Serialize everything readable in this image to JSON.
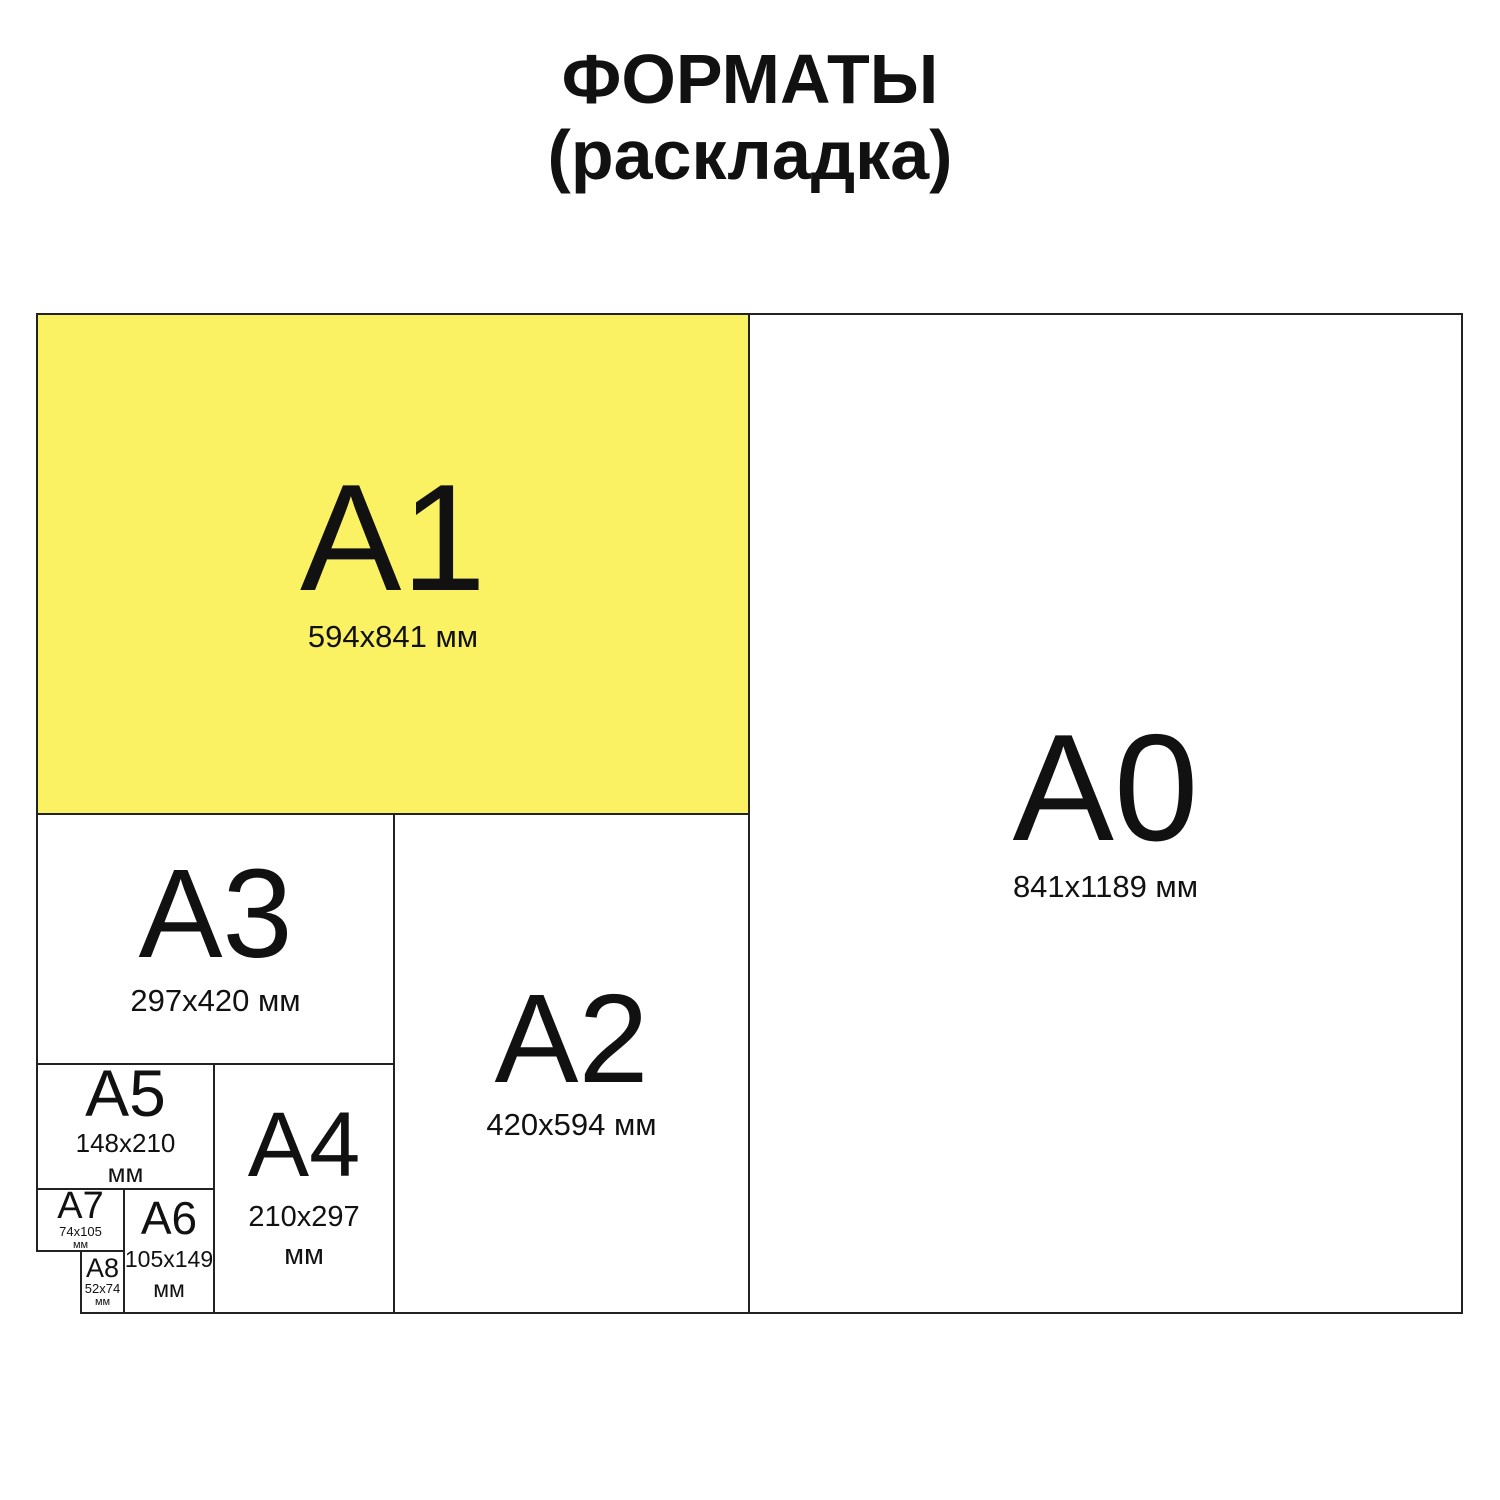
{
  "title": {
    "line1": "ФОРМАТЫ",
    "line2": "(раскладка)"
  },
  "colors": {
    "highlight": "#faf163",
    "border": "#222222",
    "text": "#111111",
    "background": "#ffffff"
  },
  "formats": {
    "a0": {
      "label": "A0",
      "size": "841x1189 мм"
    },
    "a1": {
      "label": "A1",
      "size": "594x841 мм",
      "highlighted": true
    },
    "a2": {
      "label": "A2",
      "size": "420x594 мм"
    },
    "a3": {
      "label": "A3",
      "size": "297x420 мм"
    },
    "a4": {
      "label": "A4",
      "size": "210x297",
      "unit": "мм"
    },
    "a5": {
      "label": "A5",
      "size": "148x210",
      "unit": "мм"
    },
    "a6": {
      "label": "A6",
      "size": "105x149",
      "unit": "мм"
    },
    "a7": {
      "label": "A7",
      "size": "74x105",
      "unit": "мм"
    },
    "a8": {
      "label": "A8",
      "size": "52x74",
      "unit": "мм"
    }
  }
}
